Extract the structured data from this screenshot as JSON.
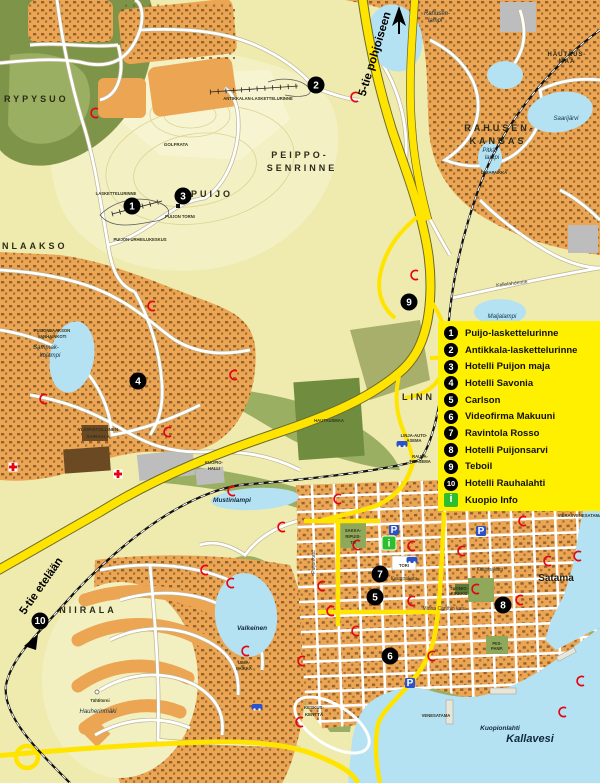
{
  "legend": {
    "background_color": "#FFF000",
    "items": [
      {
        "number": "1",
        "label": "Puijo-laskettelurinne"
      },
      {
        "number": "2",
        "label": "Antikkala-laskettelurinne"
      },
      {
        "number": "3",
        "label": "Hotelli Puijon maja"
      },
      {
        "number": "4",
        "label": "Hotelli Savonia"
      },
      {
        "number": "5",
        "label": "Carlson"
      },
      {
        "number": "6",
        "label": "Videofirma Makuuni"
      },
      {
        "number": "7",
        "label": "Ravintola Rosso"
      },
      {
        "number": "8",
        "label": "Hotelli Puijonsarvi"
      },
      {
        "number": "9",
        "label": "Teboil"
      },
      {
        "number": "10",
        "label": "Hotelli Rauhalahti"
      },
      {
        "number": "i",
        "label": "Kuopio Info"
      }
    ]
  },
  "markers": {
    "m1": "1",
    "m2": "2",
    "m3": "3",
    "m4": "4",
    "m5": "5",
    "m6": "6",
    "m7": "7",
    "m8": "8",
    "m9": "9",
    "m10": "10",
    "info": "i"
  },
  "icons": {
    "parking": "P",
    "info": "i"
  },
  "map": {
    "area_labels": {
      "rypysuo": "RYPYSUO",
      "puijonlaakso": "NLAAKSO",
      "puijo": "PUIJO",
      "peipposenrinne1": "PEIPPO-",
      "peipposenrinne2": "SENRINNE",
      "rahusenkangas1": "RAHUSEN-",
      "rahusenkangas2": "KANGAS",
      "hautausmaa1": "HAUTAUS-",
      "hautausmaa2": "MAA",
      "niirala": "NIIRALA",
      "linnanpelto": "LINN",
      "satama": "Satama",
      "keskuskentta1": "KESKUS-",
      "keskuskentta2": "KENTTÄ"
    },
    "water_labels": {
      "rahusenlampi1": "Rahusen-",
      "rahusenlampi2": "lampi",
      "saarijarvi": "Saarijärvi",
      "pitkalampi1": "Pitkä-",
      "pitkalampi2": "lampi",
      "maljalampi": "Maljalampi",
      "sammakkolampi1": "Sammak-",
      "sammakkolampi2": "kolampi",
      "mustinlampi": "Mustinlampi",
      "valkeinen": "Valkeinen",
      "kuopionlahti": "Kuopionlahti",
      "kallavesi": "Kallavesi"
    },
    "place_labels": {
      "golfrata": "GOLFRATA",
      "laskettelurinne": "LASKETTELURINNE",
      "antikkala": "ANTIKKALAN-LASKETTELURINNE",
      "puijontorni": "PUIJON TORNI",
      "urheilukeskus": "PUIJON-URHEILUKESKUS",
      "vanhainkoti1": "PUIJONLAAKSON",
      "vanhainkoti2": "VANHAINKOTI",
      "sairaala1": "YLIOPISTOLLINEN",
      "sairaala2": "SAIRAALA",
      "kuopiohalli1": "KUOPIO-",
      "kuopiohalli2": "HALLI",
      "hautausmaa": "HAUTAUSMAA",
      "bussiasema1": "LINJA-AUTO-",
      "bussiasema2": "ASEMA",
      "rautatieasema1": "RAUTA-",
      "rautatieasema2": "TIEASEMA",
      "uimapaikka1": "UIMA-",
      "uimapaikka2": "PAIKKA",
      "uimapaikka_pitka": "UIMAPAIKKA",
      "tahtitorni": "Tähtitorni",
      "hauherinmaki": "Hauherinmäki",
      "venesatama": "VENESATAMA",
      "vierasvenesatama": "VIERASVENESATAMA",
      "tuomiokirkko1": "TUOMIO-",
      "tuomiokirkko2": "KIRKKO",
      "puisto1": "SAKKA-",
      "puisto2": "RIPUIS-",
      "puisto3": "TO",
      "piispanpuisto1": "PIIS-",
      "piispanpuisto2": "PANP.",
      "tori": "TORI"
    },
    "street_labels": {
      "kellolahdentie": "Kellolahdentie",
      "puijonkatu": "Puijonkatu",
      "kauppakatu": "Kauppakatu",
      "minnacanthinkatu": "Minna Canthin katu"
    },
    "road_labels": {
      "north": "5-tie pohjoiseen",
      "south": "5-tie etelään"
    }
  },
  "colors": {
    "land": "#EFEBAE",
    "hill": "#F3F0C4",
    "forest": "#7E9549",
    "park": "#9AAF62",
    "blocks": "#ECA553",
    "water": "#B5E2F2",
    "road_major": "#FFE400",
    "legend_bg": "#FFF000",
    "marker": "#000000",
    "info_green": "#2DBE2D",
    "busstop_red": "#E30613",
    "parking_blue": "#2B52C8"
  }
}
